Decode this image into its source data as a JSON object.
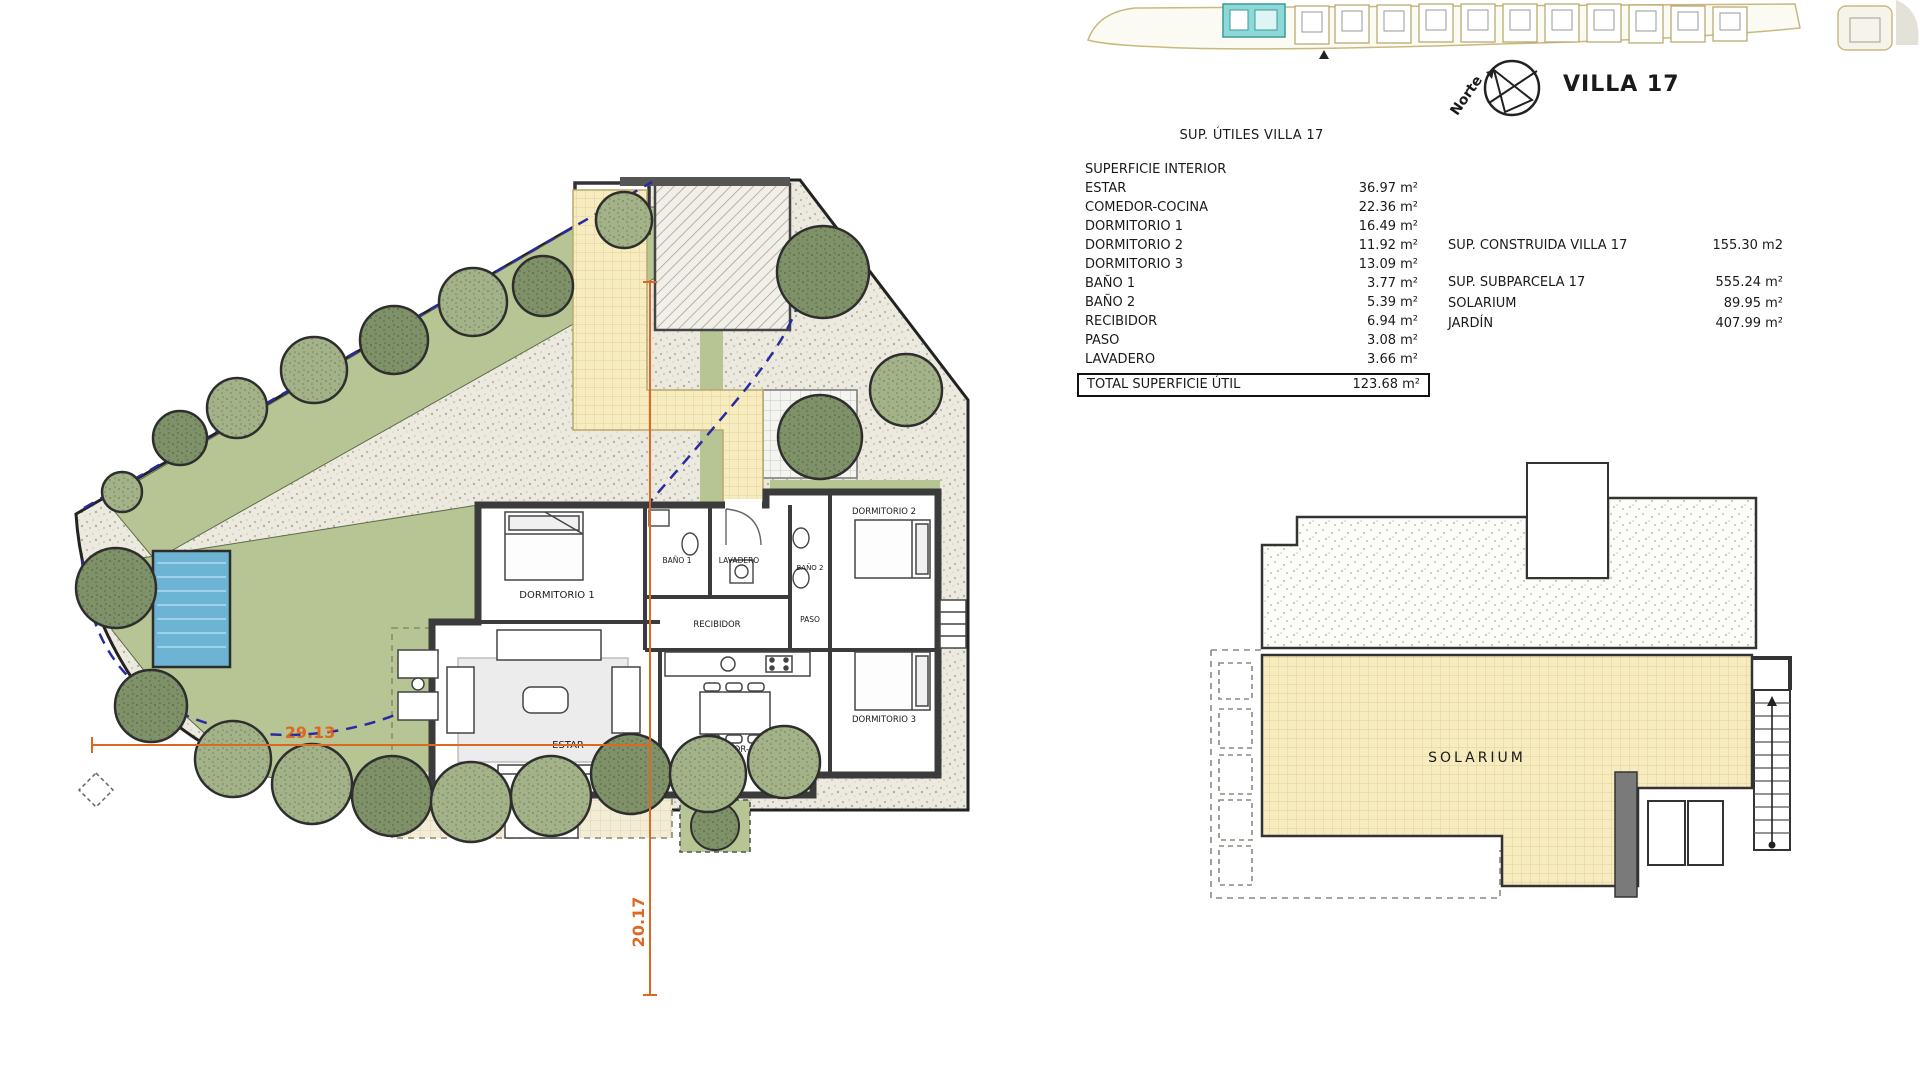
{
  "header": {
    "north_label": "Norte",
    "villa_title": "VILLA 17"
  },
  "areas_table": {
    "title": "SUP. ÚTILES VILLA 17",
    "section_header": "SUPERFICIE INTERIOR",
    "rows": [
      {
        "label": "ESTAR",
        "value": "36.97 m²"
      },
      {
        "label": "COMEDOR-COCINA",
        "value": "22.36 m²"
      },
      {
        "label": "DORMITORIO 1",
        "value": "16.49 m²"
      },
      {
        "label": "DORMITORIO 2",
        "value": "11.92 m²"
      },
      {
        "label": "DORMITORIO 3",
        "value": "13.09 m²"
      },
      {
        "label": "BAÑO 1",
        "value": "3.77 m²"
      },
      {
        "label": "BAÑO 2",
        "value": "5.39 m²"
      },
      {
        "label": "RECIBIDOR",
        "value": "6.94 m²"
      },
      {
        "label": "PASO",
        "value": "3.08 m²"
      },
      {
        "label": "LAVADERO",
        "value": "3.66 m²"
      }
    ],
    "total": {
      "label": "TOTAL SUPERFICIE ÚTIL",
      "value": "123.68 m²"
    }
  },
  "summary": {
    "construida": {
      "label": "SUP. CONSTRUIDA VILLA 17",
      "value": "155.30 m2"
    },
    "subparcela": {
      "label": "SUP. SUBPARCELA 17",
      "value": "555.24 m²"
    },
    "solarium": {
      "label": "SOLARIUM",
      "value": "89.95 m²"
    },
    "jardin": {
      "label": "JARDÍN",
      "value": "407.99 m²"
    }
  },
  "floor_plan": {
    "labels": {
      "dormitorio1": "DORMITORIO 1",
      "dormitorio2": "DORMITORIO 2",
      "dormitorio3": "DORMITORIO 3",
      "bano1": "BAÑO 1",
      "bano2": "BAÑO 2",
      "lavadero": "LAVADERO",
      "recibidor": "RECIBIDOR",
      "paso": "PASO",
      "estar": "ESTAR",
      "comedor": "COMEDOR-COCINA"
    },
    "dimensions": {
      "horizontal": "29.13",
      "vertical": "20.17"
    }
  },
  "roof_plan": {
    "label": "SOLARIUM"
  },
  "colors": {
    "garden_green": "#b7c594",
    "pool_blue": "#6db3d4",
    "dimension_orange": "#dd6820",
    "setback_blue": "#2a2aa0",
    "tile_yellow": "#f6ecc0",
    "minimap_highlight": "#8fd8d8"
  }
}
